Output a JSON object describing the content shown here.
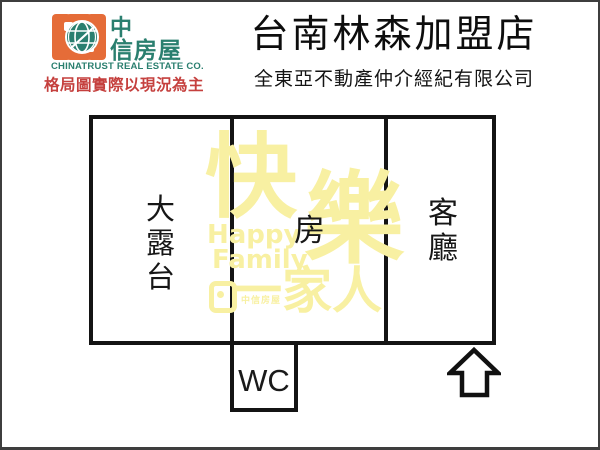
{
  "header": {
    "logo": {
      "name_line1": "中",
      "name_line2": "信房屋",
      "company_en": "CHINATRUST REAL ESTATE CO.",
      "disclaimer": "格局圖實際以現況為主"
    },
    "store_title": "台南林森加盟店",
    "agency_name": "全東亞不動產仲介經紀有限公司"
  },
  "floorplan": {
    "rooms": {
      "terrace": "大露台",
      "bedroom": "房",
      "living_room": "客廳",
      "wc": "WC"
    },
    "entrance_arrow_direction": "up"
  },
  "watermark": {
    "char1": "快",
    "char2": "樂",
    "en_line1": "Happy",
    "en_line2": "Family",
    "phrase_bottom": "一家人",
    "logo_text": "中信房屋"
  },
  "icons": {
    "logo_globe": "globe-icon",
    "entrance": "hollow-up-arrow-icon"
  },
  "colors": {
    "brand_orange": "#e56c38",
    "brand_teal": "#2a7f6f",
    "disclaimer_red": "#c5403e",
    "watermark_yellow": "#f8f0a2",
    "wall_black": "#141414"
  }
}
